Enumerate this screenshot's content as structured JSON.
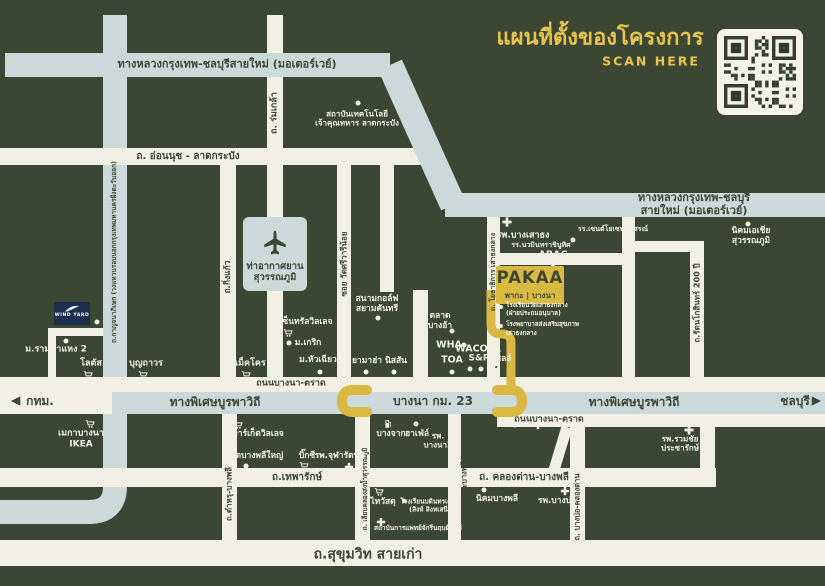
{
  "header": {
    "title": "แผนที่ตั้งของโครงการ",
    "scan_label": "SCAN HERE",
    "qr": "qr-code"
  },
  "project": {
    "name": "PAKAA",
    "subtitle": "พากะ | บางนา",
    "nearby": [
      {
        "name": "โรงเรียนวัดเสาธงกลาง",
        "detail": "(ฝ่ายประถมอนุบาล)"
      },
      {
        "name": "โรงพยาบาลส่งเสริมสุขภาพ",
        "detail": "เสาธงกลาง"
      }
    ]
  },
  "other_project": {
    "name": "WIND YARD"
  },
  "colors": {
    "background": "#3c4733",
    "road": "#f2efe4",
    "highway": "#ccd9db",
    "route_gold": "#d9b942",
    "title_gold": "#e8c44d",
    "windyard_navy": "#1c2f4f"
  },
  "map": {
    "labels": [
      {
        "n": "road-label-motorway-1",
        "t": "ทางหลวงกรุงเทพ-ชลบุรีสายใหม่ (มอเตอร์เวย์)",
        "x": 227,
        "y": 65,
        "f": 11,
        "k": "ink"
      },
      {
        "n": "road-label-motorway-2",
        "t": "ทางหลวงกรุงเทพ-ชลบุรีสายใหม่ (มอเตอร์เวย์)",
        "x": 694,
        "y": 205,
        "f": 11,
        "k": "ink"
      },
      {
        "n": "road-label-onnut",
        "t": "ถ. อ่อนนุช - ลาดกระบัง",
        "x": 188,
        "y": 157,
        "f": 10,
        "k": "ink"
      },
      {
        "n": "road-label-romklao",
        "t": "ถ. ร่มเกล้า",
        "x": 275,
        "y": 113,
        "f": 9,
        "k": "ink",
        "r": 1
      },
      {
        "n": "road-label-kanchanaphisek",
        "t": "ถ.กาญจนาภิเษก (วงแหวนรอบนอกกรุงเทพมหานครฝั่งตะวันออก)",
        "x": 115,
        "y": 252,
        "f": 6.5,
        "k": "ink",
        "r": 1
      },
      {
        "n": "road-label-kingkaew",
        "t": "ถ.กิ่งแก้ว",
        "x": 228,
        "y": 277,
        "f": 8.5,
        "k": "ink",
        "r": 1
      },
      {
        "n": "road-label-srivaree",
        "t": "ซอย วัดศรีวารีน้อย",
        "x": 344,
        "y": 264,
        "f": 8,
        "k": "ink",
        "r": 1
      },
      {
        "n": "road-label-yothathikan",
        "t": "ถ. โยธาธิการ เสาธงกลาง",
        "x": 493,
        "y": 272,
        "f": 7,
        "k": "ink",
        "r": 1
      },
      {
        "n": "road-label-rattanakosin200",
        "t": "ถ.รัตนโกสินทร์ 200 ปี",
        "x": 697,
        "y": 303,
        "f": 8,
        "k": "ink",
        "r": 1
      },
      {
        "n": "road-label-bangna-trad-1",
        "t": "ถนนบางนา-ตราด",
        "x": 291,
        "y": 384,
        "f": 9,
        "k": "ink"
      },
      {
        "n": "road-label-bangna-trad-2",
        "t": "ถนนบางนา-ตราด",
        "x": 549,
        "y": 420,
        "f": 9,
        "k": "ink"
      },
      {
        "n": "road-label-burapha-west",
        "t": "ทางพิเศษบูรพาวิถี",
        "x": 215,
        "y": 402,
        "f": 12,
        "k": "ink"
      },
      {
        "n": "road-label-bangna-km23",
        "t": "บางนา กม. 23",
        "x": 433,
        "y": 401,
        "f": 12,
        "k": "ink"
      },
      {
        "n": "road-label-burapha-east",
        "t": "ทางพิเศษบูรพาวิถี",
        "x": 634,
        "y": 402,
        "f": 12,
        "k": "ink"
      },
      {
        "n": "direction-label-bangkok",
        "t": "กทม.",
        "x": 40,
        "y": 401,
        "f": 12,
        "k": "ink"
      },
      {
        "n": "direction-label-chonburi",
        "t": "ชลบุรี",
        "x": 795,
        "y": 401,
        "f": 12,
        "k": "ink"
      },
      {
        "n": "road-label-theparak",
        "t": "ถ.เทพารักษ์",
        "x": 297,
        "y": 478,
        "f": 10,
        "k": "ink"
      },
      {
        "n": "road-label-tamru",
        "t": "ถ.ตำหรุ-บางพลี",
        "x": 229,
        "y": 494,
        "f": 8,
        "k": "ink",
        "r": 1
      },
      {
        "n": "road-label-liab-klong",
        "t": "ถ. เลียบคลองส่งน้ำสุวรรณภูมิ",
        "x": 366,
        "y": 489,
        "f": 6.5,
        "k": "ink",
        "r": 1
      },
      {
        "n": "road-label-khlongdan-bangplee",
        "t": "ถ. คลองด่าน-บางพลี",
        "x": 524,
        "y": 478,
        "f": 10,
        "k": "ink"
      },
      {
        "n": "road-label-kheha-bangplee",
        "t": "ถ. เคหะบางพลี",
        "x": 465,
        "y": 486,
        "f": 7.5,
        "k": "ink",
        "r": 1
      },
      {
        "n": "road-label-bangbo-khlongdan",
        "t": "ถ. บางบ่อ-คลองด่าน",
        "x": 578,
        "y": 507,
        "f": 7.5,
        "k": "ink",
        "r": 1
      },
      {
        "n": "road-label-sukhumvit-old",
        "t": "ถ.สุขุมวิท สายเก่า",
        "x": 368,
        "y": 555,
        "f": 14,
        "k": "ink"
      },
      {
        "n": "airport-label",
        "t": "ท่าอากาศยาน\nสุวรรณภูมิ",
        "x": 275,
        "y": 272,
        "f": 9.5,
        "k": "ink"
      },
      {
        "n": "poi-label-kmitl",
        "t": "สถาบันเทคโนโลยี\nเจ้าคุณทหาร ลาดกระบัง",
        "x": 357,
        "y": 119,
        "f": 8,
        "k": "pale"
      },
      {
        "n": "poi-label-asia-estate",
        "t": "นิคมเอเชียสุวรรณภูมิ",
        "x": 751,
        "y": 236,
        "f": 8.5,
        "k": "pale"
      },
      {
        "n": "poi-label-hospital-bangsaothong",
        "t": "รพ.บางเสาธง",
        "x": 523,
        "y": 236,
        "f": 9,
        "k": "pale"
      },
      {
        "n": "poi-label-st-joseph-school",
        "t": "รร.เซนต์โยเซฟอนุสรณ์",
        "x": 613,
        "y": 229,
        "f": 7,
        "k": "pale"
      },
      {
        "n": "poi-label-nawamin-school",
        "t": "รร.นวมินทราชินูทิศ",
        "x": 541,
        "y": 245,
        "f": 7,
        "k": "pale"
      },
      {
        "n": "poi-label-abac",
        "t": "ABAC",
        "x": 553,
        "y": 255,
        "f": 9.5,
        "k": "pale"
      },
      {
        "n": "poi-label-golf",
        "t": "สนามกอล์ฟ\nสยามคันทรี",
        "x": 377,
        "y": 304,
        "f": 8.5,
        "k": "pale"
      },
      {
        "n": "poi-label-central-village",
        "t": "เซ็นทรัลวิลเลจ",
        "x": 306,
        "y": 322,
        "f": 8.5,
        "k": "pale"
      },
      {
        "n": "poi-label-krirk-university",
        "t": "ม.เกริก",
        "x": 308,
        "y": 343,
        "f": 8.5,
        "k": "pale"
      },
      {
        "n": "poi-label-huachiew-university",
        "t": "ม.หัวเฉียว",
        "x": 318,
        "y": 360,
        "f": 8.5,
        "k": "pale"
      },
      {
        "n": "poi-label-ramkhamhaeng2",
        "t": "ม.รามคำแหง 2",
        "x": 56,
        "y": 350,
        "f": 9,
        "k": "pale"
      },
      {
        "n": "poi-label-lotus",
        "t": "โลตัส",
        "x": 91,
        "y": 364,
        "f": 9,
        "k": "pale"
      },
      {
        "n": "poi-label-boonthavorn",
        "t": "บุญถาวร",
        "x": 146,
        "y": 364,
        "f": 9,
        "k": "pale"
      },
      {
        "n": "poi-label-makro",
        "t": "แม็คโคร",
        "x": 249,
        "y": 364,
        "f": 9,
        "k": "pale"
      },
      {
        "n": "poi-label-yamaha",
        "t": "ยามาฮ่า",
        "x": 367,
        "y": 361,
        "f": 8.5,
        "k": "pale"
      },
      {
        "n": "poi-label-nissan",
        "t": "นิสสัน",
        "x": 396,
        "y": 361,
        "f": 8.5,
        "k": "pale"
      },
      {
        "n": "poi-label-market-bang-a",
        "t": "ตลาด\nบางอ้า",
        "x": 440,
        "y": 321,
        "f": 8.5,
        "k": "pale"
      },
      {
        "n": "poi-label-wha",
        "t": "WHA",
        "x": 449,
        "y": 345,
        "f": 9.5,
        "k": "pale"
      },
      {
        "n": "poi-label-toa",
        "t": "TOA",
        "x": 452,
        "y": 360,
        "f": 9.5,
        "k": "pale"
      },
      {
        "n": "poi-label-wacoal",
        "t": "WACOAL",
        "x": 478,
        "y": 349,
        "f": 9.5,
        "k": "pale"
      },
      {
        "n": "poi-label-sp",
        "t": "S&P",
        "x": 479,
        "y": 359,
        "f": 9,
        "k": "pale"
      },
      {
        "n": "poi-label-shell",
        "t": "เชลล์",
        "x": 502,
        "y": 359,
        "f": 8.5,
        "k": "pale"
      },
      {
        "n": "poi-label-mega-ikea",
        "t": "เมกาบางนา\nIKEA",
        "x": 81,
        "y": 439,
        "f": 9,
        "k": "pale"
      },
      {
        "n": "poi-label-market-village",
        "t": "มาร์เก็ตวิลเลจ",
        "x": 258,
        "y": 434,
        "f": 8.5,
        "k": "pale"
      },
      {
        "n": "poi-label-wat-bangplee-yai",
        "t": "วัดบางพลีใหญ่",
        "x": 257,
        "y": 456,
        "f": 8.5,
        "k": "pale"
      },
      {
        "n": "poi-label-bigc",
        "t": "บิ๊กซี",
        "x": 307,
        "y": 456,
        "f": 8.5,
        "k": "pale"
      },
      {
        "n": "poi-label-chularat3-hospital",
        "t": "รพ.จุฬารัตน์3",
        "x": 340,
        "y": 456,
        "f": 8.5,
        "k": "pale"
      },
      {
        "n": "poi-label-bangchak",
        "t": "บางจาก",
        "x": 391,
        "y": 434,
        "f": 8.5,
        "k": "pale"
      },
      {
        "n": "poi-label-hafele",
        "t": "ฮาเฟ่ล์",
        "x": 417,
        "y": 434,
        "f": 8.5,
        "k": "pale"
      },
      {
        "n": "poi-label-bangna2-hospital",
        "t": "รพ.\nบางนา2",
        "x": 438,
        "y": 441,
        "f": 8,
        "k": "pale"
      },
      {
        "n": "poi-label-thaiwatsadu",
        "t": "ไทวัสดุ",
        "x": 383,
        "y": 502,
        "f": 8.5,
        "k": "pale"
      },
      {
        "n": "poi-label-bodindecha-school",
        "t": "โรงเรียนบดินทรเดชา\n(สิงห์ สิงหเสนี)",
        "x": 430,
        "y": 506,
        "f": 6.5,
        "k": "pale"
      },
      {
        "n": "poi-label-chakri-medical",
        "t": "สถาบันการแพทย์จักรีนฤบดินทร์",
        "x": 418,
        "y": 529,
        "f": 6.5,
        "k": "pale"
      },
      {
        "n": "poi-label-nikhom-bangplee",
        "t": "นิคมบางพลี",
        "x": 497,
        "y": 499,
        "f": 8.5,
        "k": "pale"
      },
      {
        "n": "poi-label-bangbo-hospital",
        "t": "รพ.บางบ่อ",
        "x": 557,
        "y": 501,
        "f": 8.5,
        "k": "pale"
      },
      {
        "n": "poi-label-ruamchai-hospital",
        "t": "รพ.รวมชัย\nประชารักษ์",
        "x": 680,
        "y": 444,
        "f": 8,
        "k": "pale"
      }
    ],
    "icons": [
      {
        "n": "airplane-icon",
        "x": 275,
        "y": 243,
        "s": 30,
        "k": "ink"
      },
      {
        "n": "arrow-left-icon",
        "x": 15,
        "y": 401,
        "s": 14,
        "k": "ink"
      },
      {
        "n": "arrow-right-icon",
        "x": 817,
        "y": 401,
        "s": 14,
        "k": "ink"
      },
      {
        "n": "hospital-cross-icon",
        "x": 507,
        "y": 222,
        "s": 11
      },
      {
        "n": "hospital-cross-icon",
        "x": 349,
        "y": 467,
        "s": 10
      },
      {
        "n": "hospital-cross-icon",
        "x": 453,
        "y": 426,
        "s": 10
      },
      {
        "n": "hospital-cross-icon",
        "x": 538,
        "y": 425,
        "s": 10
      },
      {
        "n": "hospital-cross-icon",
        "x": 689,
        "y": 430,
        "s": 11
      },
      {
        "n": "hospital-cross-icon",
        "x": 565,
        "y": 491,
        "s": 10
      },
      {
        "n": "hospital-cross-icon",
        "x": 381,
        "y": 522,
        "s": 10
      },
      {
        "n": "cart-icon",
        "x": 88,
        "y": 375,
        "s": 10
      },
      {
        "n": "cart-icon",
        "x": 143,
        "y": 375,
        "s": 10
      },
      {
        "n": "cart-icon",
        "x": 246,
        "y": 375,
        "s": 10
      },
      {
        "n": "cart-icon",
        "x": 288,
        "y": 333,
        "s": 10
      },
      {
        "n": "cart-icon",
        "x": 90,
        "y": 424,
        "s": 10
      },
      {
        "n": "cart-icon",
        "x": 238,
        "y": 425,
        "s": 10
      },
      {
        "n": "cart-icon",
        "x": 304,
        "y": 466,
        "s": 10
      },
      {
        "n": "cart-icon",
        "x": 379,
        "y": 492,
        "s": 10
      },
      {
        "n": "fuel-icon",
        "x": 388,
        "y": 424,
        "s": 9
      },
      {
        "n": "fuel-icon",
        "x": 497,
        "y": 369,
        "s": 9
      },
      {
        "n": "poi-dot",
        "x": 358,
        "y": 103,
        "s": 6
      },
      {
        "n": "poi-dot",
        "x": 748,
        "y": 224,
        "s": 6
      },
      {
        "n": "poi-dot",
        "x": 573,
        "y": 240,
        "s": 6
      },
      {
        "n": "poi-dot",
        "x": 553,
        "y": 264,
        "s": 6
      },
      {
        "n": "poi-dot",
        "x": 378,
        "y": 318,
        "s": 6
      },
      {
        "n": "poi-dot",
        "x": 289,
        "y": 343,
        "s": 6
      },
      {
        "n": "poi-dot",
        "x": 320,
        "y": 372,
        "s": 6
      },
      {
        "n": "poi-dot",
        "x": 66,
        "y": 341,
        "s": 6
      },
      {
        "n": "poi-dot",
        "x": 97,
        "y": 322,
        "s": 6
      },
      {
        "n": "poi-dot",
        "x": 366,
        "y": 372,
        "s": 6
      },
      {
        "n": "poi-dot",
        "x": 394,
        "y": 372,
        "s": 6
      },
      {
        "n": "poi-dot",
        "x": 452,
        "y": 331,
        "s": 6
      },
      {
        "n": "poi-dot",
        "x": 464,
        "y": 345,
        "s": 6
      },
      {
        "n": "poi-dot",
        "x": 452,
        "y": 372,
        "s": 6
      },
      {
        "n": "poi-dot",
        "x": 470,
        "y": 369,
        "s": 6
      },
      {
        "n": "poi-dot",
        "x": 481,
        "y": 369,
        "s": 6
      },
      {
        "n": "poi-dot",
        "x": 416,
        "y": 424,
        "s": 6
      },
      {
        "n": "poi-dot",
        "x": 515,
        "y": 425,
        "s": 6
      },
      {
        "n": "poi-dot",
        "x": 246,
        "y": 466,
        "s": 6
      },
      {
        "n": "poi-dot",
        "x": 484,
        "y": 490,
        "s": 6
      },
      {
        "n": "poi-dot",
        "x": 404,
        "y": 501,
        "s": 5
      }
    ]
  }
}
